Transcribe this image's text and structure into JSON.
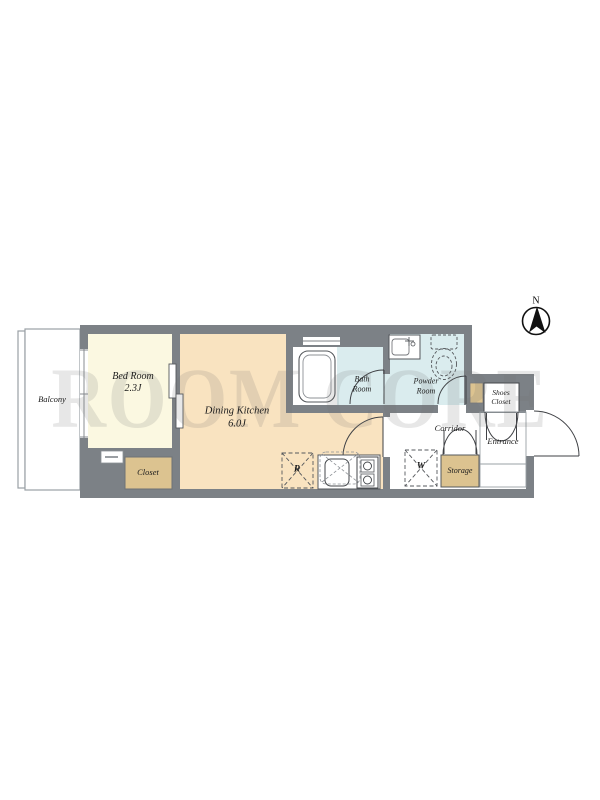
{
  "watermark": {
    "text": "ROOM CORE"
  },
  "compass": {
    "north_label": "N"
  },
  "rooms": {
    "balcony": {
      "label": "Balcony"
    },
    "bed_room": {
      "name": "Bed Room",
      "size": "2.3J"
    },
    "dining_kitchen": {
      "name": "Dining Kitchen",
      "size": "6.0J"
    },
    "closet": {
      "label": "Closet"
    },
    "bath_room": {
      "line1": "Bath",
      "line2": "Room"
    },
    "powder_room": {
      "line1": "Powder",
      "line2": "Room"
    },
    "shoes_closet": {
      "line1": "Shoes",
      "line2": "Closet"
    },
    "corridor": {
      "label": "Corridor"
    },
    "entrance": {
      "label": "Entrance"
    },
    "storage": {
      "label": "Storage"
    }
  },
  "appliances": {
    "refrigerator_mark": "R",
    "washer_mark": "W"
  },
  "colors": {
    "wall": "#7c8186",
    "bedroom_floor": "#fbf8e1",
    "kitchen_floor": "#f9e3c0",
    "wet_area_floor": "#daecee",
    "closet_fill": "#dcc390",
    "outline": "#3f4145"
  }
}
